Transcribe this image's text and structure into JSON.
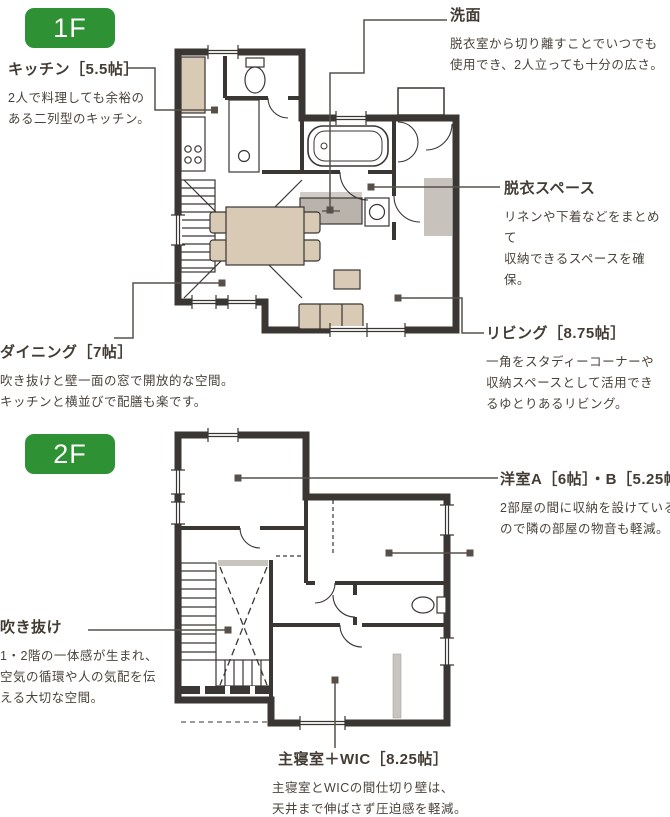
{
  "page": {
    "background": "#ffffff"
  },
  "colors": {
    "badge_green": "#2e9235",
    "wall": "#3a3633",
    "text": "#453e37",
    "leader": "#57504a",
    "furniture_beige": "#d8cab4",
    "fixture_gray": "#c8c2bc"
  },
  "floor1": {
    "badge": "1F",
    "callouts": {
      "kitchen": {
        "title": "キッチン［5.5帖］",
        "body": "2人で料理しても余裕の\nある二列型のキッチン。"
      },
      "washbasin": {
        "title": "洗面",
        "body": "脱衣室から切り離すことでいつでも\n使用でき、2人立っても十分の広さ。"
      },
      "dressing": {
        "title": "脱衣スペース",
        "body": "リネンや下着などをまとめて\n収納できるスペースを確保。"
      },
      "living": {
        "title": "リビング［8.75帖］",
        "body": "一角をスタディーコーナーや\n収納スペースとして活用でき\nるゆとりあるリビング。"
      },
      "dining": {
        "title": "ダイニング［7帖］",
        "body": "吹き抜けと壁一面の窓で開放的な空間。\nキッチンと横並びで配膳も楽です。"
      }
    }
  },
  "floor2": {
    "badge": "2F",
    "callouts": {
      "rooms_ab": {
        "title": "洋室A［6帖］・B［5.25帖］",
        "body": "2部屋の間に収納を設けている\nので隣の部屋の物音も軽減。"
      },
      "void": {
        "title": "吹き抜け",
        "body": "1・2階の一体感が生まれ、\n空気の循環や人の気配を伝\nえる大切な空間。"
      },
      "master": {
        "title": "主寝室＋WIC［8.25帖］",
        "body": "主寝室とWICの間仕切り壁は、\n天井まで伸ばさず圧迫感を軽減。"
      }
    }
  }
}
